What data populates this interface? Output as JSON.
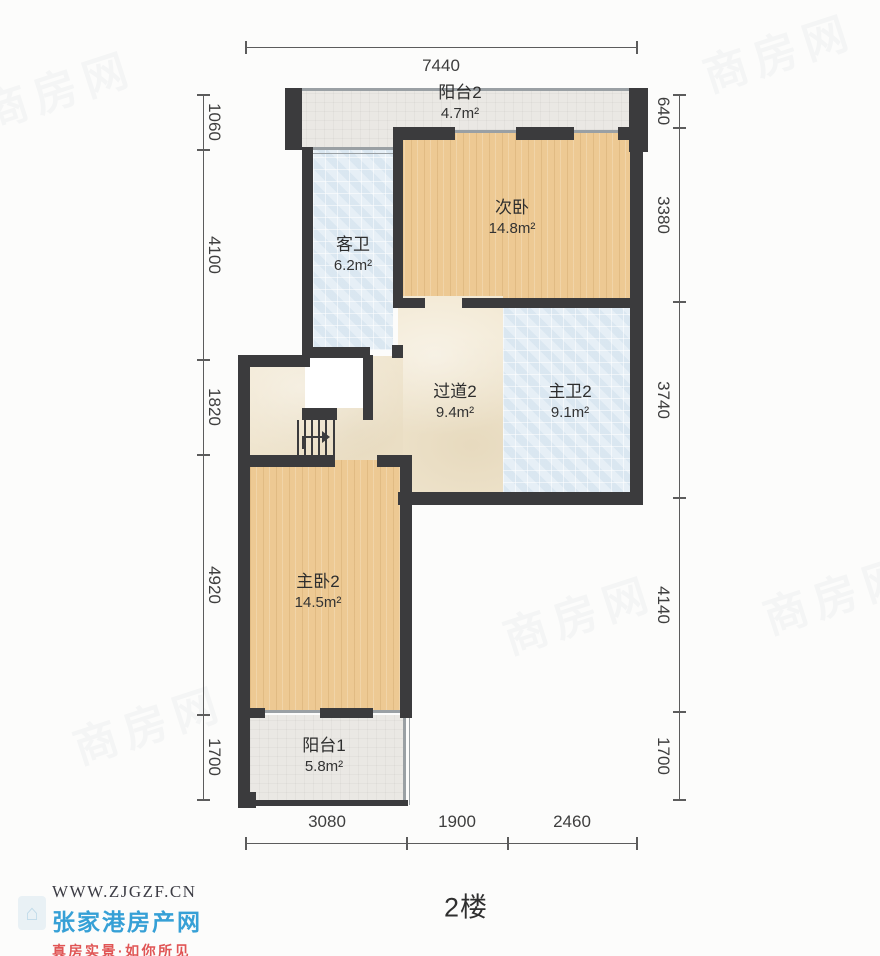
{
  "title": "2楼",
  "rooms": [
    {
      "name": "阳台2",
      "area": "4.7m²"
    },
    {
      "name": "次卧",
      "area": "14.8m²"
    },
    {
      "name": "客卫",
      "area": "6.2m²"
    },
    {
      "name": "过道2",
      "area": "9.4m²"
    },
    {
      "name": "主卫2",
      "area": "9.1m²"
    },
    {
      "name": "主卧2",
      "area": "14.5m²"
    },
    {
      "name": "阳台1",
      "area": "5.8m²"
    }
  ],
  "dimensions": {
    "top": [
      "7440"
    ],
    "left": [
      "1060",
      "4100",
      "1820",
      "4920",
      "1700"
    ],
    "right": [
      "640",
      "3380",
      "3740",
      "4140",
      "1700"
    ],
    "bottom": [
      "3080",
      "1900",
      "2460"
    ]
  },
  "watermark": {
    "text": "商房网"
  },
  "footer_logo": {
    "website": "WWW.ZJGZF.CN",
    "site_name": "张家港房产网",
    "slogan": "真房实景·如你所见",
    "house_icon_glyph": "⌂"
  },
  "colors": {
    "wall": "#3b3b3d",
    "wood": "#edc993",
    "tile": "#e6eff6",
    "cream": "#f2e8d2",
    "balcony": "#eae8e4",
    "logo_blue": "#36a0d6",
    "logo_red": "#e05555"
  }
}
